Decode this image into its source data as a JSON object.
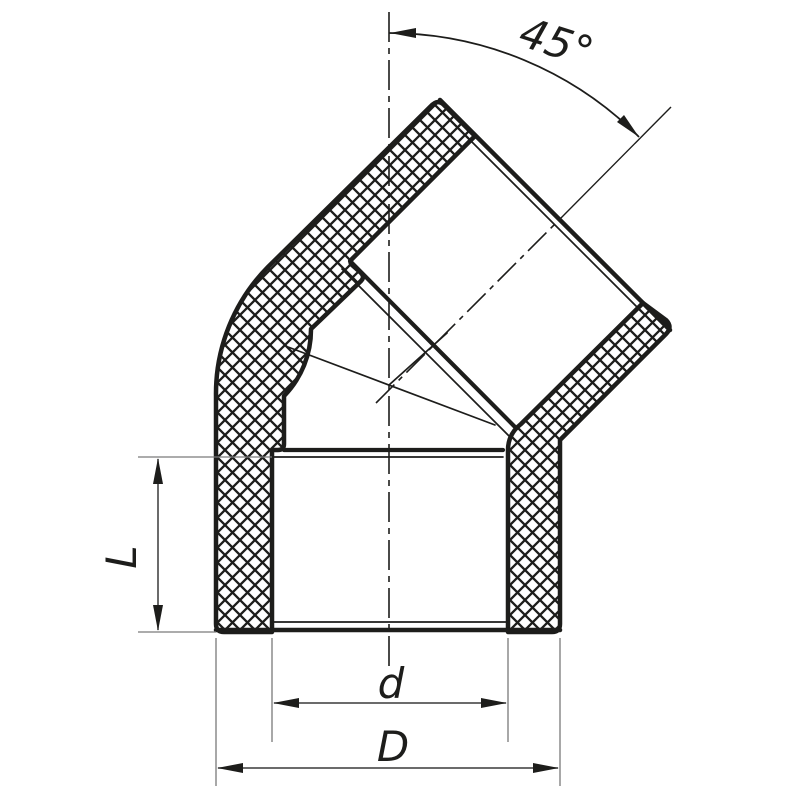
{
  "drawing": {
    "background": "#ffffff",
    "ink_color": "#1d1d1b",
    "extension_line_color": "#7a7a7a",
    "labels": {
      "angle": "45°",
      "socket_depth": "L",
      "inner_diameter": "d",
      "outer_diameter": "D"
    }
  }
}
